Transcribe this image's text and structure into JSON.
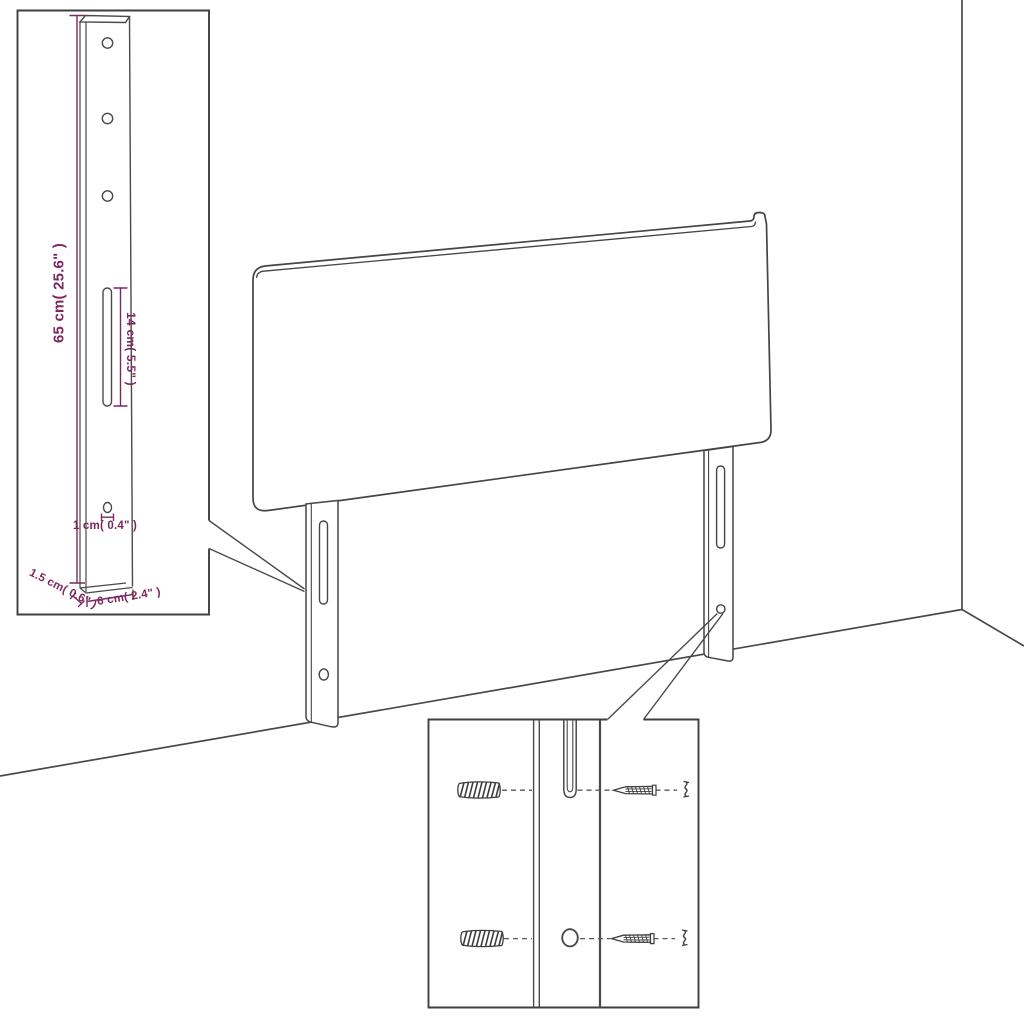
{
  "scene": {
    "type": "product-assembly-diagram",
    "subject": "upholstered headboard with two wall-mount legs",
    "background": "#ffffff"
  },
  "colors": {
    "line": "#454545",
    "dimension": "#7c2760"
  },
  "leg_detail_inset": {
    "labels": {
      "height": "65 cm( 25.6\" )",
      "slot": "14 cm( 5.5\" )",
      "hole": "1 cm( 0.4\" )",
      "depth": "1.5 cm( 0.6\" )",
      "width": "6 cm( 2.4\" )"
    }
  },
  "mounting_inset": {
    "icons": {
      "wall_plug": "wall-plug-icon",
      "screw": "screw-icon",
      "screw_head": "screw-head-icon",
      "slot": "slot-icon",
      "hole": "hole-icon"
    }
  }
}
